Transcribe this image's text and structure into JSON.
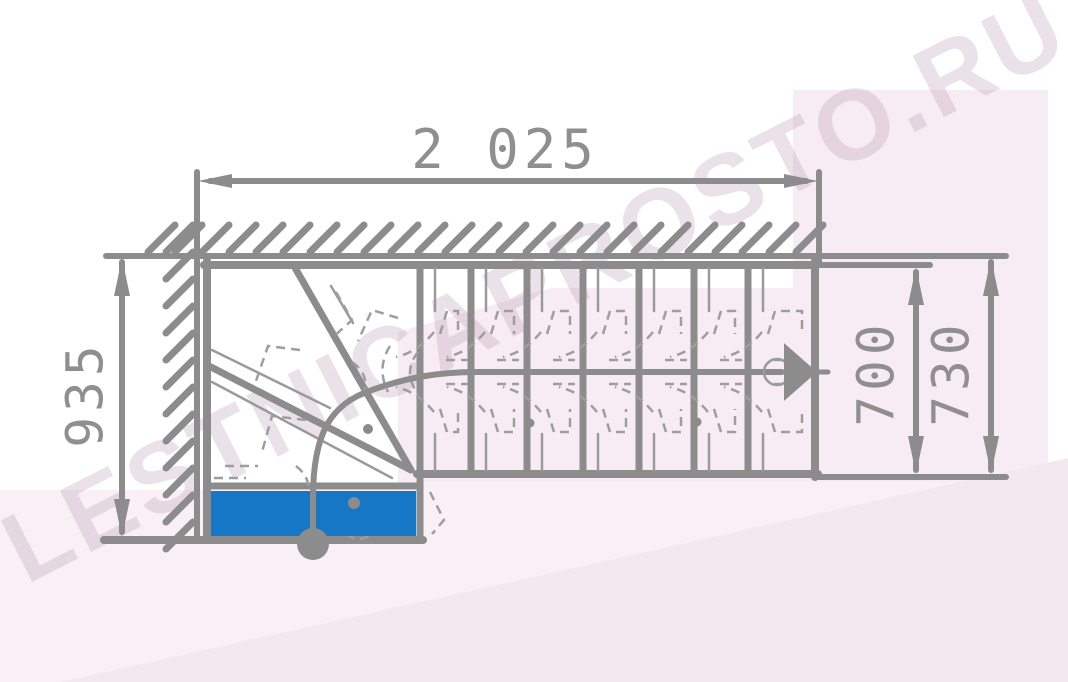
{
  "meta": {
    "title": "Staircase floor plan (top view) with dimensions"
  },
  "watermark": {
    "text": "LESTNICAPROSTO.RU"
  },
  "dimensions": {
    "top_width": {
      "label": "2 025"
    },
    "left_depth": {
      "label": "935"
    },
    "flight_inner": {
      "label": "700"
    },
    "flight_outer": {
      "label": "730"
    }
  },
  "plan": {
    "first_step_color": "#1577c6",
    "line_color": "#8c8c8c",
    "detail_color": "#9e9e9e",
    "dim_text_color": "#8f8f8f",
    "backdrop_pink": "#f8ecf4",
    "straight_treads": 7,
    "winder_treads": 3,
    "walk_direction": "right"
  }
}
